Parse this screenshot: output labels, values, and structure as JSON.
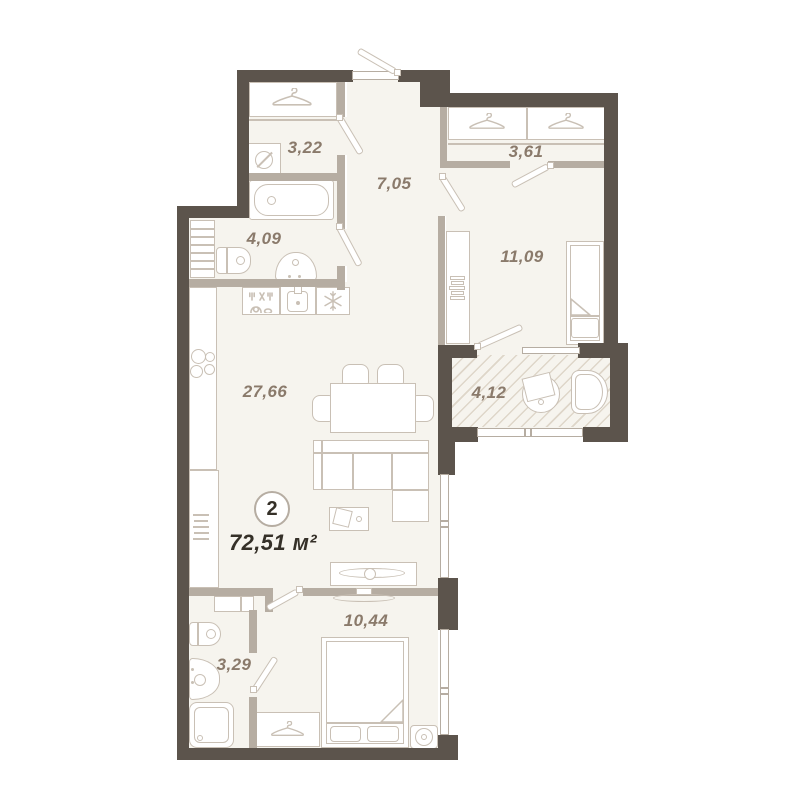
{
  "badge": {
    "number": "2",
    "total_area": "72,51 м²"
  },
  "rooms": {
    "closet322": {
      "area": "3,22"
    },
    "hall705": {
      "area": "7,05"
    },
    "wardrobe361": {
      "area": "3,61"
    },
    "bath409": {
      "area": "4,09"
    },
    "bedroom1109": {
      "area": "11,09"
    },
    "living2766": {
      "area": "27,66"
    },
    "balcony412": {
      "area": "4,12"
    },
    "bedroom1044": {
      "area": "10,44"
    },
    "bath329": {
      "area": "3,29"
    }
  },
  "icons": [
    "hanger-icon",
    "washing-machine-icon",
    "snowflake-fridge-icon",
    "dishwasher-icon"
  ],
  "colors": {
    "wall": "#5c544c",
    "part": "#b6ada2",
    "floor": "#f6f4ee",
    "furn": "#c9c0b5",
    "label": "#8a7a6b",
    "dark": "#353028",
    "hatch": "#ded6c9",
    "bg": "#ffffff"
  }
}
